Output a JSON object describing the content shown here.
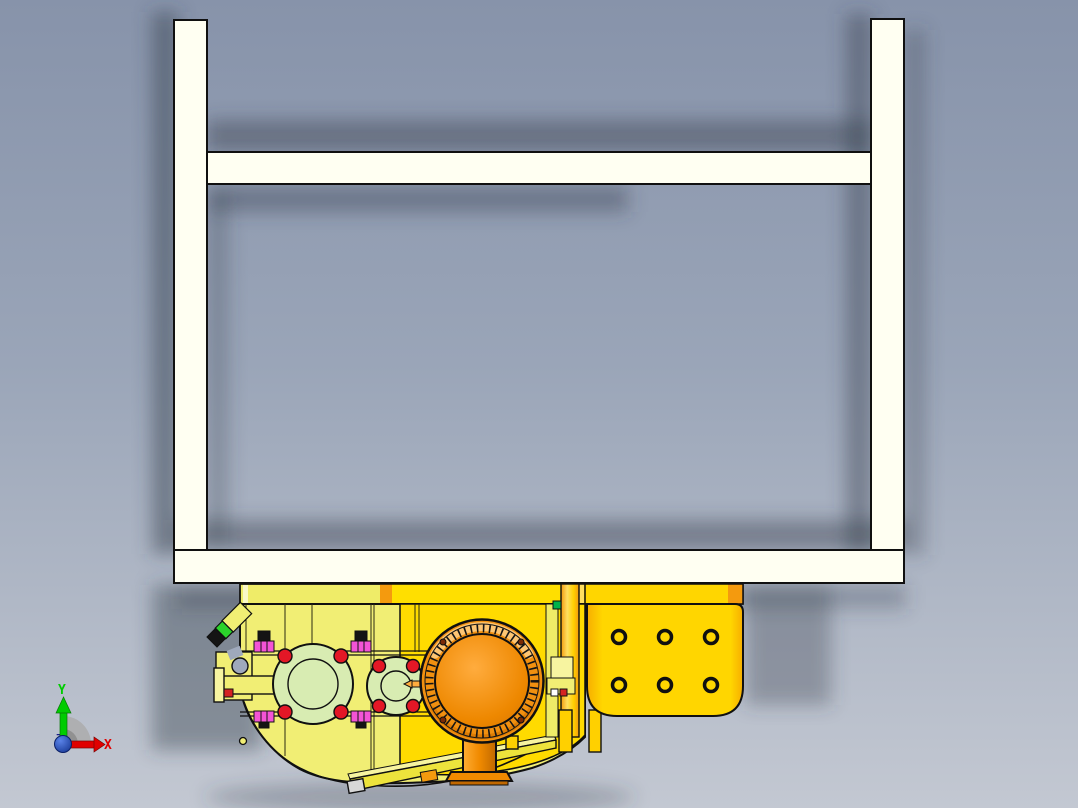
{
  "viewer": {
    "type": "cad-3d-viewport",
    "model": "yellow machine assembly with white support frame",
    "axis_triad": {
      "x_label": "X",
      "y_label": "Y",
      "z_label": "Z"
    },
    "colors": {
      "background_top": "#8793AA",
      "background_mid": "#9AA5B8",
      "background_bottom": "#C3C8D2",
      "shadow": "#39424F",
      "frame": "#FFFFF2",
      "outline": "#101010",
      "body_pale": "#F1EE74",
      "body_pale_light": "#F7F4A0",
      "body_gold": "#FFDB00",
      "band_left": "#EFEC68",
      "band_mid": "#FFDF00",
      "plate_gold": "#FFD600",
      "plate_edge": "#F7AE00",
      "stripe_orange": "#F49A0E",
      "stripe_light": "#FFDF60",
      "flange_green": "#D8ECB2",
      "bolt_red": "#E31726",
      "fastener_magenta": "#F353D6",
      "fastener_black": "#141414",
      "gear_ring": "#F19010",
      "gear_ring_highlight": "#FFCF85",
      "gear_ring_dark": "#D67300",
      "gear_face": "#EE8800",
      "gear_face_highlight": "#FFAC3E",
      "gear_bolt_dark": "#7A2A06",
      "pedestal_orange": "#F08A00",
      "pedestal_light": "#FFAD33",
      "pedestal_dark": "#C06800",
      "stub_green": "#2BD22B",
      "chip_green": "#00B34A",
      "chip_red": "#D42222",
      "chip_white": "#FFFFFF",
      "foot_gray": "#D7D7D7",
      "leg_gold": "#FFD000",
      "strip_yellow": "#EDE33C",
      "axis_x": "#E00000",
      "axis_y": "#00CC00",
      "axis_z": "#1A1A8C",
      "origin_sphere_light": "#5A83E8",
      "origin_sphere_dark": "#13338F",
      "wedge_gray": "#ACACAC",
      "wedge_gray_dark": "#8E8E8E"
    }
  }
}
